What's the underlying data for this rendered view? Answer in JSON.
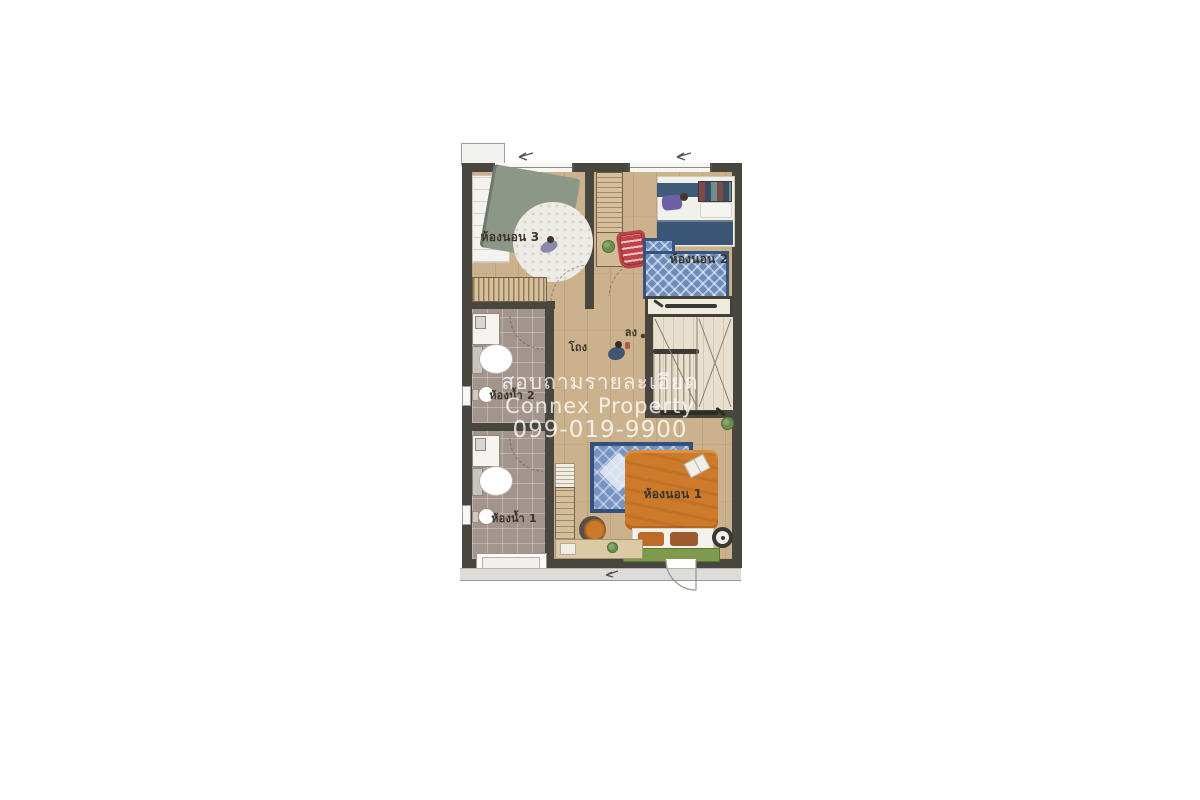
{
  "image_type": "real-estate floor plan (upper storey of a townhome), watermarked",
  "watermark": {
    "line1": "สอบถามรายละเอียด",
    "line2": "Connex Property",
    "line3": "099-019-9900",
    "color": "rgba(255,255,255,0.78)"
  },
  "plan": {
    "rooms": {
      "bedroom3": {
        "label": "ห้องนอน 3"
      },
      "bedroom2": {
        "label": "ห้องนอน 2"
      },
      "bedroom1": {
        "label": "ห้องนอน 1"
      },
      "bathroom2": {
        "label": "ห้องน้ำ 2"
      },
      "bathroom1": {
        "label": "ห้องน้ำ 1"
      },
      "hall": {
        "label": "โถง"
      },
      "stairs_down": {
        "label": "ลง"
      }
    },
    "colors": {
      "wall": "#49453f",
      "wood_floor": "#ccb28c",
      "bathroom_tile": "#a3948e",
      "stair_floor": "#e9dfce",
      "bed1_orange": "#cd7b2b",
      "bed2_navy": "#3a5674",
      "bed3_sage": "#8d9788",
      "rug_blue": "#6d8cbb",
      "bench_green": "#7d9a4d",
      "chair_red": "#bf4348",
      "background": "#ffffff"
    }
  }
}
